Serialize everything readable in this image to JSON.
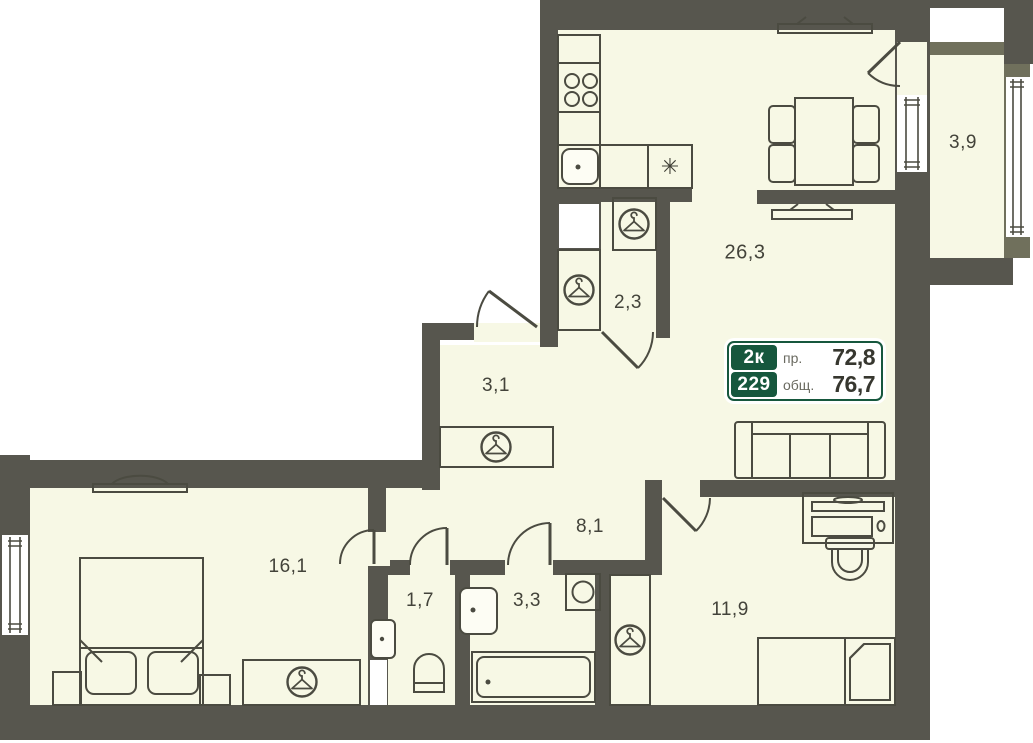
{
  "floor_plan": {
    "rooms": [
      {
        "name": "balcony",
        "area": "3,9"
      },
      {
        "name": "kitchen-living-room",
        "area": "26,3"
      },
      {
        "name": "wardrobe-room",
        "area": "2,3"
      },
      {
        "name": "entry-hall",
        "area": "3,1"
      },
      {
        "name": "corridor",
        "area": "8,1"
      },
      {
        "name": "bedroom",
        "area": "16,1"
      },
      {
        "name": "wc",
        "area": "1,7"
      },
      {
        "name": "bathroom",
        "area": "3,3"
      },
      {
        "name": "bedroom-2",
        "area": "11,9"
      }
    ],
    "info_box": {
      "type_label": "2к",
      "apartment_number": "229",
      "design_area_label": "пр.",
      "design_area_value": "72,8",
      "total_area_label": "общ.",
      "total_area_value": "76,7"
    },
    "symbols": {
      "fridge": "✳"
    },
    "icons": {
      "wardrobe": "hanger-icon",
      "appliance": "asterisk-icon"
    },
    "colors": {
      "wall": "#57564e",
      "balcony_wall": "#70705c",
      "floor": "#f7f8e5",
      "outline": "#4b4b41",
      "accent_green": "#16573d",
      "label_text": "#43433a"
    }
  }
}
